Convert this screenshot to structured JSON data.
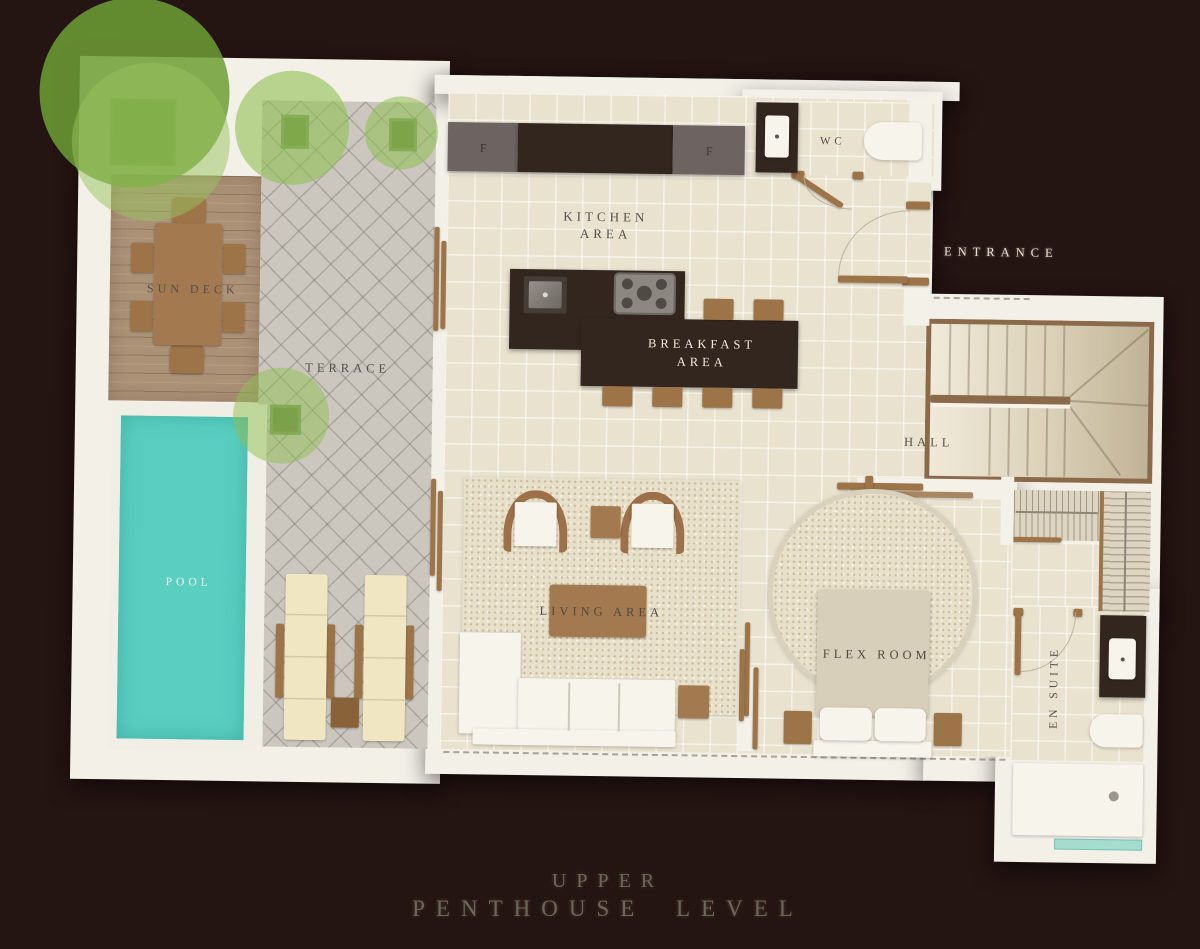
{
  "plan": {
    "title": {
      "line1": "UPPER",
      "line2": "PENTHOUSE LEVEL"
    },
    "rooms": {
      "sun_deck": "SUN DECK",
      "terrace": "TERRACE",
      "pool": "POOL",
      "kitchen": {
        "line1": "KITCHEN",
        "line2": "AREA"
      },
      "breakfast": {
        "line1": "BREAKFAST",
        "line2": "AREA"
      },
      "living": "LIVING AREA",
      "flex": "FLEX ROOM",
      "hall": "HALL",
      "wc": "WC",
      "ensuite": "EN SUITE",
      "entrance": "ENTRANCE"
    },
    "appliances": {
      "fridge_left": "F",
      "fridge_right": "F"
    },
    "colors": {
      "background": "#241412",
      "wall_white": "#f3f0e8",
      "floor_tile": "#e9e2cf",
      "terrace_gray": "#cbc7bf",
      "deck_wood": "#ab9176",
      "furniture_wood": "#9c7448",
      "counter_dark": "#33261f",
      "cabinet_gray": "#6d6462",
      "pool_water": "#5acfc1",
      "tree_green": "#7fb142",
      "lounger_cream": "#f0e7c2",
      "label_dark": "#55504a",
      "label_light": "#f0e9dc"
    }
  }
}
